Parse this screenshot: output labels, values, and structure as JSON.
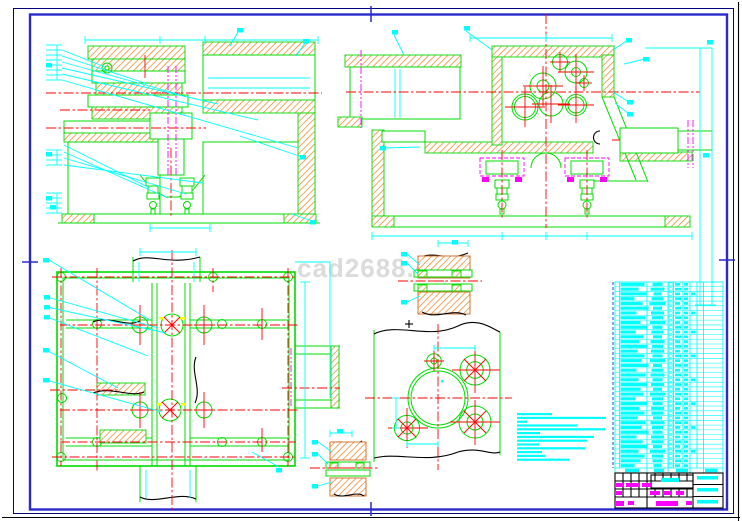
{
  "watermark": {
    "text": "cad2688.cu"
  },
  "palette": {
    "background": "#FFFFFF",
    "line_green": "#00DC00",
    "dim_cyan": "#00FFFF",
    "center_red": "#FF0000",
    "phantom_magenta": "#FF00FF",
    "hatch_orange": "#E8821E",
    "hatch_border": "#D2691E",
    "frame_outer_navy": "#000080",
    "frame_inner_blue": "#2A2ACC",
    "break_black": "#000000",
    "accent_yellow": "#FFFF00",
    "watermark_gray": "#DBDBDB"
  },
  "notes": {
    "lines": [
      35,
      89,
      10,
      60,
      88,
      23,
      77,
      70,
      22,
      68,
      25,
      28,
      52
    ]
  },
  "parts_list": {
    "rows": [
      [
        24,
        10,
        5,
        4,
        0
      ],
      [
        18,
        14,
        6,
        4,
        0
      ],
      [
        26,
        8,
        5,
        4,
        4
      ],
      [
        14,
        12,
        6,
        4,
        0
      ],
      [
        22,
        16,
        5,
        4,
        0
      ],
      [
        28,
        9,
        6,
        4,
        0
      ],
      [
        16,
        13,
        5,
        4,
        4
      ],
      [
        25,
        11,
        6,
        4,
        0
      ],
      [
        20,
        15,
        5,
        4,
        0
      ],
      [
        27,
        10,
        6,
        4,
        0
      ],
      [
        15,
        12,
        5,
        4,
        4
      ],
      [
        23,
        9,
        6,
        4,
        0
      ],
      [
        19,
        14,
        5,
        4,
        0
      ],
      [
        26,
        11,
        6,
        4,
        0
      ],
      [
        17,
        13,
        5,
        4,
        0
      ],
      [
        24,
        10,
        6,
        4,
        4
      ],
      [
        21,
        15,
        5,
        4,
        0
      ],
      [
        28,
        9,
        6,
        4,
        0
      ],
      [
        16,
        12,
        5,
        4,
        0
      ],
      [
        25,
        14,
        6,
        4,
        0
      ],
      [
        18,
        10,
        5,
        4,
        4
      ],
      [
        26,
        13,
        6,
        4,
        0
      ],
      [
        20,
        9,
        5,
        4,
        0
      ],
      [
        23,
        15,
        6,
        4,
        0
      ],
      [
        15,
        11,
        5,
        4,
        0
      ],
      [
        27,
        10,
        6,
        4,
        4
      ],
      [
        19,
        13,
        5,
        4,
        0
      ],
      [
        24,
        12,
        6,
        4,
        0
      ],
      [
        17,
        9,
        5,
        4,
        0
      ],
      [
        25,
        14,
        6,
        4,
        0
      ],
      [
        21,
        11,
        5,
        4,
        4
      ],
      [
        28,
        10,
        6,
        4,
        0
      ],
      [
        16,
        13,
        5,
        4,
        0
      ],
      [
        22,
        12,
        6,
        4,
        0
      ],
      [
        26,
        9,
        5,
        4,
        0
      ],
      [
        18,
        15,
        6,
        4,
        4
      ],
      [
        24,
        11,
        5,
        4,
        0
      ],
      [
        20,
        10,
        6,
        4,
        0
      ],
      [
        14,
        8,
        5,
        4,
        0
      ]
    ],
    "header_blocks": [
      [
        625,
        14
      ],
      [
        654,
        10
      ],
      [
        676,
        12
      ],
      [
        705,
        12
      ]
    ]
  },
  "title_block": {
    "magenta_bars": [
      [
        616,
        483,
        8,
        4
      ],
      [
        626,
        483,
        14,
        4
      ],
      [
        642,
        483,
        10,
        4
      ],
      [
        616,
        491,
        6,
        4
      ],
      [
        650,
        491,
        10,
        4
      ],
      [
        664,
        491,
        8,
        4
      ],
      [
        676,
        491,
        8,
        4
      ],
      [
        616,
        501,
        8,
        5
      ],
      [
        628,
        501,
        6,
        4
      ],
      [
        656,
        501,
        22,
        5
      ],
      [
        686,
        501,
        6,
        4
      ]
    ],
    "cyan_bars": [
      [
        661,
        478,
        18,
        4
      ],
      [
        697,
        476,
        21,
        3.5
      ],
      [
        697,
        488,
        21,
        3.5
      ],
      [
        697,
        500,
        21,
        3.5
      ]
    ]
  },
  "markers": [
    [
      237,
      28
    ],
    [
      303,
      39
    ],
    [
      300,
      155
    ],
    [
      310,
      220
    ],
    [
      46,
      63
    ],
    [
      46,
      152
    ],
    [
      46,
      196
    ],
    [
      50,
      205
    ],
    [
      464,
      26
    ],
    [
      392,
      30
    ],
    [
      626,
      38
    ],
    [
      643,
      57
    ],
    [
      627,
      100
    ],
    [
      627,
      112
    ],
    [
      380,
      146
    ],
    [
      703,
      153
    ],
    [
      707,
      40
    ],
    [
      43,
      258
    ],
    [
      44,
      295
    ],
    [
      44,
      305
    ],
    [
      44,
      315
    ],
    [
      43,
      348
    ],
    [
      43,
      378
    ],
    [
      276,
      468
    ],
    [
      401,
      252
    ],
    [
      401,
      261
    ],
    [
      401,
      300
    ],
    [
      452,
      240
    ],
    [
      312,
      440
    ],
    [
      312,
      452
    ],
    [
      312,
      484
    ],
    [
      337,
      429
    ]
  ]
}
